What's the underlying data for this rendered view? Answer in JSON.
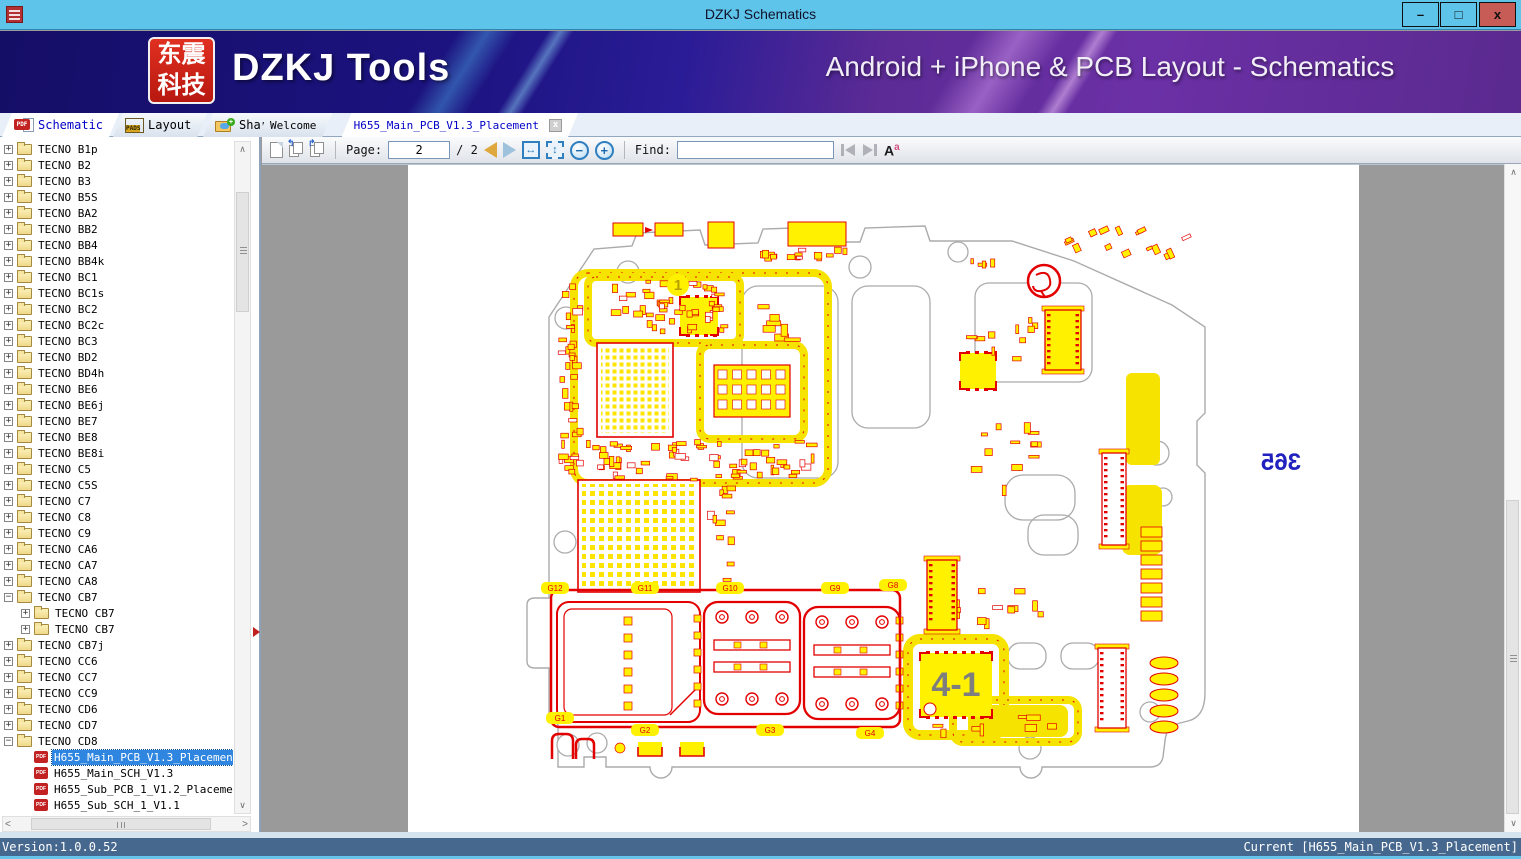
{
  "window": {
    "title": "DZKJ Schematics",
    "minimize": "–",
    "maximize": "□",
    "close": "x"
  },
  "logo": {
    "line1": "东震",
    "line2": "科技"
  },
  "banner": {
    "app_name": "DZKJ Tools",
    "tagline": "Android + iPhone & PCB Layout - Schematics"
  },
  "tabs": {
    "left": [
      {
        "label": "Schematic",
        "icon": "pdf",
        "icon_text": "PDF",
        "active": true
      },
      {
        "label": "Layout",
        "icon": "pads",
        "icon_text": "PADS",
        "active": false
      },
      {
        "label": "Share",
        "icon": "share",
        "icon_text": "",
        "active": false
      }
    ],
    "docs": [
      {
        "label": "Welcome",
        "active": false,
        "closable": false
      },
      {
        "label": "H655_Main_PCB_V1.3_Placement",
        "active": true,
        "closable": true,
        "close_glyph": "x"
      }
    ]
  },
  "toolbar": {
    "page_label": "Page:",
    "page_value": "2",
    "page_total": "/ 2",
    "find_label": "Find:",
    "find_value": "",
    "font_icon": "A",
    "font_icon_sup": "a"
  },
  "tree": {
    "items": [
      {
        "label": "TECNO B1p",
        "level": 0,
        "type": "folder",
        "expander": "+"
      },
      {
        "label": "TECNO B2",
        "level": 0,
        "type": "folder",
        "expander": "+"
      },
      {
        "label": "TECNO B3",
        "level": 0,
        "type": "folder",
        "expander": "+"
      },
      {
        "label": "TECNO B5S",
        "level": 0,
        "type": "folder",
        "expander": "+"
      },
      {
        "label": "TECNO BA2",
        "level": 0,
        "type": "folder",
        "expander": "+"
      },
      {
        "label": "TECNO BB2",
        "level": 0,
        "type": "folder",
        "expander": "+"
      },
      {
        "label": "TECNO BB4",
        "level": 0,
        "type": "folder",
        "expander": "+"
      },
      {
        "label": "TECNO BB4k",
        "level": 0,
        "type": "folder",
        "expander": "+"
      },
      {
        "label": "TECNO BC1",
        "level": 0,
        "type": "folder",
        "expander": "+"
      },
      {
        "label": "TECNO BC1s",
        "level": 0,
        "type": "folder",
        "expander": "+"
      },
      {
        "label": "TECNO BC2",
        "level": 0,
        "type": "folder",
        "expander": "+"
      },
      {
        "label": "TECNO BC2c",
        "level": 0,
        "type": "folder",
        "expander": "+"
      },
      {
        "label": "TECNO BC3",
        "level": 0,
        "type": "folder",
        "expander": "+"
      },
      {
        "label": "TECNO BD2",
        "level": 0,
        "type": "folder",
        "expander": "+"
      },
      {
        "label": "TECNO BD4h",
        "level": 0,
        "type": "folder",
        "expander": "+"
      },
      {
        "label": "TECNO BE6",
        "level": 0,
        "type": "folder",
        "expander": "+"
      },
      {
        "label": "TECNO BE6j",
        "level": 0,
        "type": "folder",
        "expander": "+"
      },
      {
        "label": "TECNO BE7",
        "level": 0,
        "type": "folder",
        "expander": "+"
      },
      {
        "label": "TECNO BE8",
        "level": 0,
        "type": "folder",
        "expander": "+"
      },
      {
        "label": "TECNO BE8i",
        "level": 0,
        "type": "folder",
        "expander": "+"
      },
      {
        "label": "TECNO C5",
        "level": 0,
        "type": "folder",
        "expander": "+"
      },
      {
        "label": "TECNO C5S",
        "level": 0,
        "type": "folder",
        "expander": "+"
      },
      {
        "label": "TECNO C7",
        "level": 0,
        "type": "folder",
        "expander": "+"
      },
      {
        "label": "TECNO C8",
        "level": 0,
        "type": "folder",
        "expander": "+"
      },
      {
        "label": "TECNO C9",
        "level": 0,
        "type": "folder",
        "expander": "+"
      },
      {
        "label": "TECNO CA6",
        "level": 0,
        "type": "folder",
        "expander": "+"
      },
      {
        "label": "TECNO CA7",
        "level": 0,
        "type": "folder",
        "expander": "+"
      },
      {
        "label": "TECNO CA8",
        "level": 0,
        "type": "folder",
        "expander": "+"
      },
      {
        "label": "TECNO CB7",
        "level": 0,
        "type": "folder",
        "expander": "-"
      },
      {
        "label": "TECNO CB7",
        "level": 1,
        "type": "folder",
        "expander": "+"
      },
      {
        "label": "TECNO CB7",
        "level": 1,
        "type": "folder",
        "expander": "+"
      },
      {
        "label": "TECNO CB7j",
        "level": 0,
        "type": "folder",
        "expander": "+"
      },
      {
        "label": "TECNO CC6",
        "level": 0,
        "type": "folder",
        "expander": "+"
      },
      {
        "label": "TECNO CC7",
        "level": 0,
        "type": "folder",
        "expander": "+"
      },
      {
        "label": "TECNO CC9",
        "level": 0,
        "type": "folder",
        "expander": "+"
      },
      {
        "label": "TECNO CD6",
        "level": 0,
        "type": "folder",
        "expander": "+"
      },
      {
        "label": "TECNO CD7",
        "level": 0,
        "type": "folder",
        "expander": "+"
      },
      {
        "label": "TECNO CD8",
        "level": 0,
        "type": "folder",
        "expander": "-"
      },
      {
        "label": "H655_Main_PCB_V1.3_Placement",
        "level": 1,
        "type": "pdf",
        "selected": true
      },
      {
        "label": "H655_Main_SCH_V1.3",
        "level": 1,
        "type": "pdf"
      },
      {
        "label": "H655_Sub_PCB_1_V1.2_Placement",
        "level": 1,
        "type": "pdf"
      },
      {
        "label": "H655_Sub_SCH_1_V1.1",
        "level": 1,
        "type": "pdf"
      }
    ]
  },
  "pcb": {
    "marker_1": "1",
    "marker_41": "4-1",
    "mirrored_number": "365",
    "g_labels": [
      "G12",
      "G11",
      "G10",
      "G9",
      "G8",
      "G1",
      "G2",
      "G3",
      "G4"
    ],
    "colors": {
      "component_yellow": "#FFF100",
      "shield_yellow": "#F6E300",
      "outline_red": "#E30000",
      "board_gray": "#ABABAB",
      "mirror_blue": "#2121BF"
    }
  },
  "status": {
    "version": "Version:1.0.0.52",
    "current": "Current [H655_Main_PCB_V1.3_Placement]"
  }
}
